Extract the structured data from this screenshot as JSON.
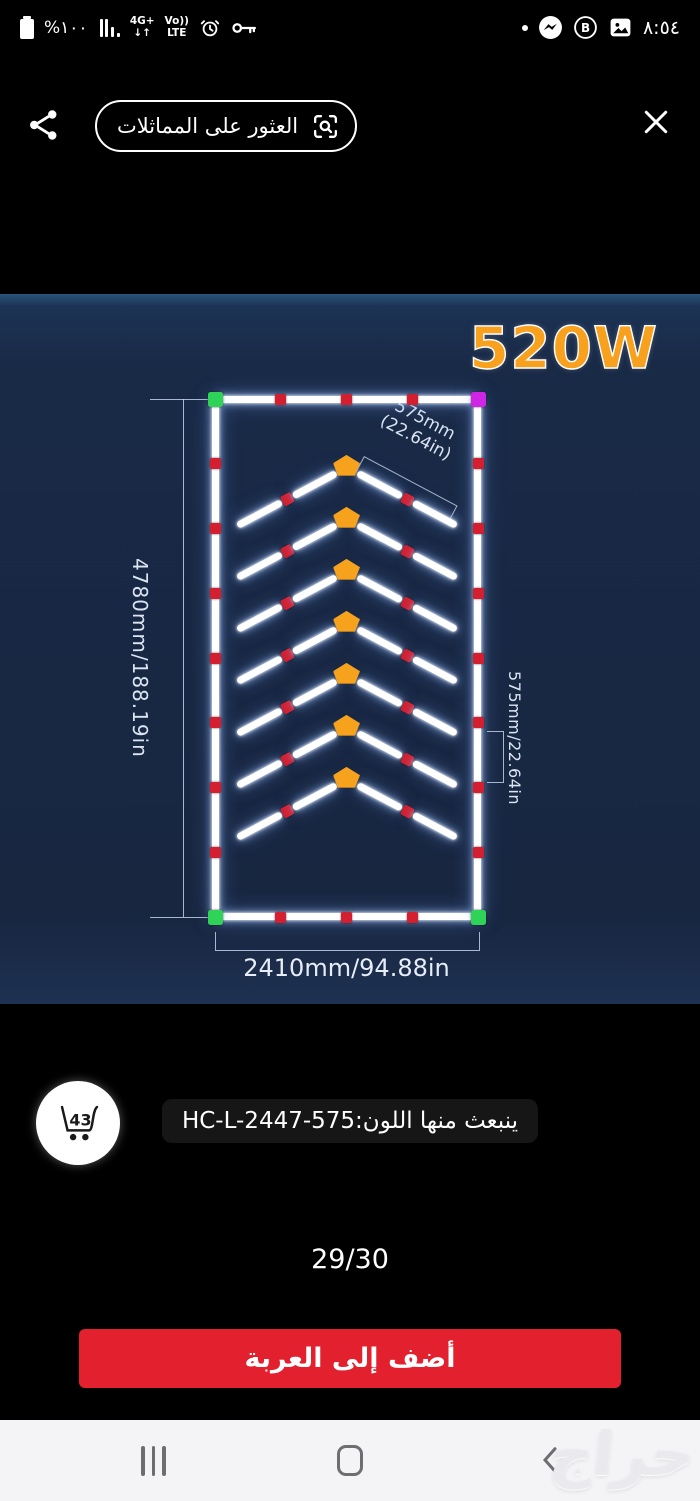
{
  "status_bar": {
    "battery_text": "%١٠٠",
    "network_line1": "4G+",
    "network_line2": "↓↑",
    "volte_line1": "Vo))",
    "volte_line2": "LTE",
    "time": "٨:٥٤"
  },
  "toolbar": {
    "find_similar_label": "العثور على المماثلات"
  },
  "product": {
    "power": "520W",
    "height_dim": "4780mm/188.19in",
    "width_dim": "2410mm/94.88in",
    "segment_dim_line1": "575mm",
    "segment_dim_line2": "(22.64in)",
    "right_dim": "575mm/22.64in",
    "code_line": "ينبعث منها اللون:HC-L-2447-575",
    "cart_badge": "43",
    "pager": "29/30",
    "add_to_cart_label": "أضف إلى العربة",
    "watermark": "حراج"
  },
  "colors": {
    "image_bg": "#192a47",
    "tube_white": "#ffffff",
    "connector_red": "#d31f2f",
    "corner_green": "#2ed357",
    "corner_magenta": "#cf25e4",
    "arrow_orange": "#f6a21c",
    "power_orange": "#f7a11e",
    "button_red": "#e3202e"
  },
  "diagram": {
    "chevron_count": 7,
    "top_connectors": 3,
    "side_connectors": 7
  }
}
